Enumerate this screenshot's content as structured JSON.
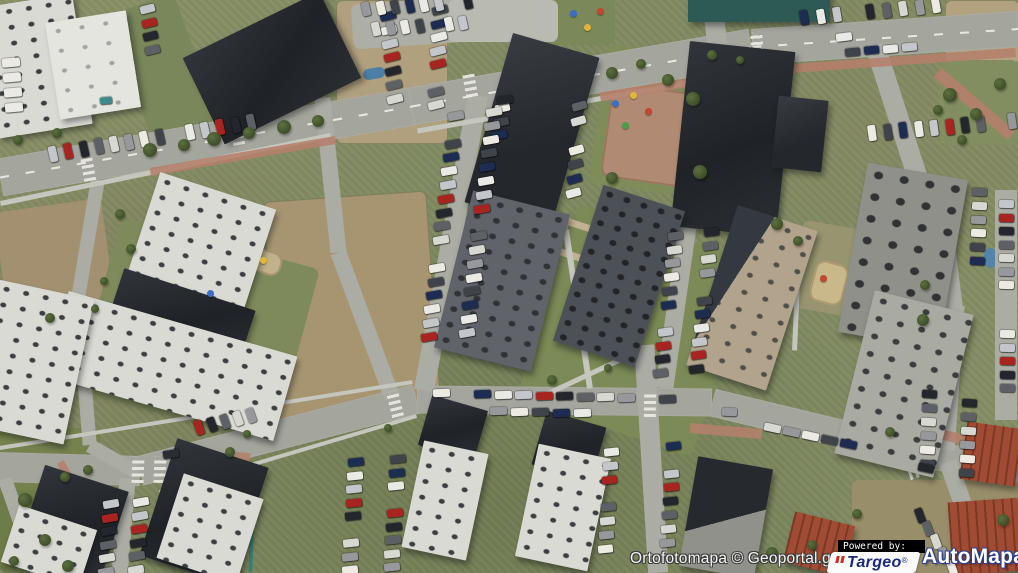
{
  "attribution": {
    "text": "Ortofotomapa © Geoportal.gov.pl"
  },
  "branding": {
    "powered_by": "Powered by:",
    "targeo": {
      "name": "Targeo",
      "reg": "®",
      "color": "#1b2a7d",
      "accent": "#cf2a21",
      "bg": "#fbfbfb"
    },
    "automapa": {
      "name": "AutoMapa",
      "reg": "®",
      "color": "#ffffff",
      "outline": "#2c3f8f"
    }
  },
  "map": {
    "type": "orthophoto-aerial",
    "scene": "residential blocks with dark flat-roof apartment buildings, roads, parking lots, lawns and dirt fields",
    "palette": {
      "grass": "#848d64",
      "road": "#a4a59d",
      "sidewalk": "#c5c6be",
      "brick_path": "#b5806b",
      "dark_roof": "#24272c",
      "light_roof": "#d9dad3",
      "red_roof": "#a04b33",
      "dirt": "#b1a07e"
    }
  },
  "features": {
    "patches": [
      [
        336,
        0,
        110,
        142,
        "#b1a07e",
        0,
        "dirt"
      ],
      [
        945,
        0,
        73,
        62,
        "#b2a280",
        0,
        "dirt"
      ],
      [
        0,
        205,
        108,
        100,
        "#a29070",
        -8,
        ""
      ],
      [
        270,
        196,
        162,
        218,
        "#a79572",
        -4,
        "dirt"
      ],
      [
        795,
        232,
        150,
        88,
        "#97946f",
        10,
        ""
      ],
      [
        852,
        480,
        168,
        93,
        "#998e6a",
        0,
        ""
      ],
      [
        543,
        228,
        185,
        205,
        "#7b8a57",
        18,
        ""
      ],
      [
        598,
        52,
        125,
        140,
        "#7e8c5a",
        8,
        ""
      ],
      [
        0,
        428,
        100,
        145,
        "#75824e",
        0,
        ""
      ],
      [
        95,
        240,
        205,
        180,
        "#7e8a5c",
        15,
        ""
      ],
      [
        130,
        0,
        70,
        145,
        "#79875a",
        -20,
        ""
      ],
      [
        545,
        0,
        70,
        45,
        "#7a885a",
        0,
        ""
      ],
      [
        940,
        60,
        78,
        85,
        "#828e60",
        0,
        ""
      ],
      [
        0,
        490,
        55,
        83,
        "#6e7c49",
        0,
        ""
      ],
      [
        606,
        88,
        92,
        95,
        "#b08a72",
        8,
        "play"
      ],
      [
        812,
        262,
        34,
        42,
        "#c9b98a",
        15,
        "play"
      ],
      [
        196,
        282,
        42,
        30,
        "#c2b28c",
        18,
        "play"
      ],
      [
        250,
        250,
        32,
        24,
        "#c2b28c",
        18,
        "play"
      ],
      [
        550,
        213,
        8,
        88,
        "#c0b292",
        18,
        ""
      ],
      [
        558,
        222,
        44,
        7,
        "#c0b292",
        18,
        ""
      ],
      [
        548,
        252,
        48,
        7,
        "#c0b292",
        18,
        ""
      ],
      [
        573,
        282,
        8,
        40,
        "#c0b292",
        18,
        ""
      ],
      [
        352,
        0,
        130,
        45,
        "#adaea6",
        -4,
        ""
      ],
      [
        448,
        0,
        110,
        42,
        "#b9bab2",
        0,
        ""
      ],
      [
        363,
        68,
        22,
        11,
        "#4d7fa6",
        -10,
        ""
      ],
      [
        984,
        248,
        13,
        20,
        "#5583aa",
        0,
        ""
      ],
      [
        250,
        484,
        4,
        88,
        "#3e7f74",
        2,
        ""
      ]
    ],
    "roads": [
      [
        0,
        177,
        412,
        106,
        38,
        "road"
      ],
      [
        412,
        106,
        752,
        47,
        38,
        "road"
      ],
      [
        752,
        47,
        1018,
        29,
        36,
        "road"
      ],
      [
        -5,
        467,
        140,
        471,
        30,
        "road"
      ],
      [
        140,
        471,
        417,
        399,
        30,
        "road"
      ],
      [
        417,
        399,
        712,
        402,
        28,
        "road"
      ],
      [
        712,
        402,
        940,
        457,
        28,
        "road"
      ],
      [
        940,
        457,
        1020,
        469,
        28,
        "road"
      ],
      [
        322,
        98,
        338,
        252,
        16,
        "road2"
      ],
      [
        338,
        252,
        392,
        397,
        16,
        "road2"
      ],
      [
        478,
        95,
        424,
        390,
        20,
        "road2"
      ],
      [
        687,
        228,
        664,
        388,
        18,
        "road2"
      ],
      [
        644,
        345,
        658,
        573,
        20,
        "road2"
      ],
      [
        875,
        45,
        921,
        188,
        20,
        "road2"
      ],
      [
        937,
        185,
        953,
        308,
        20,
        "road2"
      ],
      [
        955,
        305,
        945,
        450,
        20,
        "road2"
      ],
      [
        712,
        0,
        718,
        52,
        20,
        "road2"
      ],
      [
        948,
        462,
        972,
        530,
        18,
        "road2"
      ],
      [
        98,
        180,
        78,
        300,
        14,
        "road2"
      ],
      [
        78,
        300,
        90,
        445,
        14,
        "road2"
      ],
      [
        90,
        445,
        138,
        472,
        14,
        "road2"
      ],
      [
        128,
        478,
        120,
        573,
        16,
        "road2"
      ],
      [
        1006,
        190,
        1006,
        420,
        22,
        "road2"
      ],
      [
        5,
        478,
        38,
        573,
        14,
        "road2"
      ],
      [
        0,
        203,
        330,
        135,
        5,
        "path"
      ],
      [
        418,
        131,
        740,
        74,
        5,
        "path"
      ],
      [
        0,
        448,
        413,
        382,
        4,
        "path"
      ],
      [
        160,
        492,
        417,
        416,
        4,
        "path"
      ],
      [
        566,
        230,
        590,
        388,
        6,
        "path"
      ],
      [
        800,
        230,
        795,
        350,
        5,
        "path"
      ],
      [
        545,
        395,
        620,
        360,
        5,
        "path"
      ],
      [
        600,
        97,
        790,
        66,
        9,
        "redpath"
      ],
      [
        792,
        68,
        1015,
        52,
        9,
        "redpath"
      ],
      [
        938,
        72,
        1012,
        135,
        12,
        "redpath"
      ],
      [
        150,
        172,
        335,
        140,
        8,
        "redpath"
      ],
      [
        690,
        428,
        762,
        434,
        10,
        "redpath"
      ],
      [
        940,
        434,
        1012,
        452,
        10,
        "redpath"
      ],
      [
        244,
        452,
        238,
        505,
        14,
        "redpath"
      ],
      [
        60,
        462,
        75,
        490,
        8,
        "redpath"
      ],
      [
        0,
        177,
        412,
        106,
        2,
        "dash"
      ],
      [
        412,
        106,
        752,
        47,
        2,
        "dash"
      ],
      [
        752,
        47,
        1018,
        29,
        2,
        "dash"
      ]
    ],
    "crossings": [
      [
        88,
        168,
        -10
      ],
      [
        237,
        132,
        -10
      ],
      [
        470,
        84,
        -10
      ],
      [
        757,
        45,
        -4
      ],
      [
        395,
        404,
        -14
      ],
      [
        160,
        470,
        2
      ],
      [
        650,
        404,
        1
      ],
      [
        905,
        455,
        13
      ],
      [
        138,
        470,
        2
      ],
      [
        921,
        470,
        70
      ]
    ],
    "buildings": [
      [
        -12,
        0,
        95,
        132,
        -9,
        "light"
      ],
      [
        52,
        16,
        82,
        98,
        -9,
        "lighter"
      ],
      [
        196,
        20,
        152,
        96,
        -26,
        "dark"
      ],
      [
        487,
        42,
        90,
        176,
        16,
        "dark2"
      ],
      [
        680,
        46,
        106,
        186,
        6,
        "dark"
      ],
      [
        775,
        98,
        50,
        72,
        6,
        "dark2"
      ],
      [
        688,
        -10,
        142,
        32,
        0,
        "teal"
      ],
      [
        852,
        170,
        102,
        172,
        10,
        "graydark"
      ],
      [
        452,
        200,
        100,
        162,
        14,
        "gray2"
      ],
      [
        576,
        194,
        86,
        164,
        18,
        "gray3"
      ],
      [
        710,
        214,
        84,
        168,
        18,
        "tanmix"
      ],
      [
        853,
        300,
        102,
        168,
        14,
        "lightdark"
      ],
      [
        140,
        188,
        122,
        112,
        18,
        "light"
      ],
      [
        112,
        288,
        138,
        58,
        18,
        "dark"
      ],
      [
        52,
        322,
        238,
        88,
        16,
        "light"
      ],
      [
        -18,
        288,
        98,
        148,
        12,
        "light"
      ],
      [
        28,
        476,
        88,
        97,
        18,
        "dark"
      ],
      [
        8,
        516,
        82,
        60,
        18,
        "light"
      ],
      [
        156,
        450,
        96,
        123,
        18,
        "dark"
      ],
      [
        168,
        484,
        84,
        89,
        18,
        "light"
      ],
      [
        424,
        402,
        58,
        52,
        16,
        "dark"
      ],
      [
        412,
        446,
        66,
        109,
        12,
        "light"
      ],
      [
        538,
        418,
        62,
        56,
        16,
        "dark"
      ],
      [
        526,
        450,
        74,
        115,
        12,
        "light"
      ],
      [
        688,
        462,
        76,
        111,
        10,
        "darkmix"
      ],
      [
        843,
        543,
        58,
        30,
        -4,
        "lighter"
      ],
      [
        788,
        518,
        62,
        52,
        14,
        "red"
      ],
      [
        950,
        500,
        70,
        73,
        -4,
        "red"
      ],
      [
        963,
        425,
        56,
        58,
        8,
        "red"
      ]
    ],
    "car_rows": [
      [
        34,
        148,
        15.2,
        -2.4,
        15,
        8,
        16,
        -13
      ],
      [
        380,
        12,
        1.2,
        13.8,
        7,
        16,
        8,
        -14
      ],
      [
        432,
        6,
        -0.6,
        13.6,
        8,
        16,
        8,
        -14
      ],
      [
        495,
        104,
        -1.5,
        13.5,
        3,
        15,
        8,
        -12
      ],
      [
        448,
        112,
        -1.7,
        13.8,
        17,
        16,
        8,
        -10
      ],
      [
        486,
        108,
        -1.7,
        13.8,
        18,
        16,
        8,
        -10
      ],
      [
        668,
        232,
        -1.5,
        13.7,
        11,
        15,
        8,
        -8
      ],
      [
        704,
        228,
        -1.5,
        13.7,
        11,
        15,
        8,
        -8
      ],
      [
        195,
        420,
        13,
        -3,
        5,
        8,
        15,
        -20
      ],
      [
        103,
        500,
        -1,
        13.5,
        6,
        16,
        8,
        -10
      ],
      [
        133,
        498,
        -1,
        13.5,
        6,
        16,
        8,
        -10
      ],
      [
        348,
        458,
        -0.8,
        13.5,
        9,
        16,
        8,
        -6
      ],
      [
        390,
        455,
        -0.8,
        13.5,
        9,
        16,
        8,
        -6
      ],
      [
        433,
        389,
        20.5,
        0.5,
        12,
        17,
        8,
        -2
      ],
      [
        490,
        407,
        21,
        0.5,
        5,
        17,
        8,
        -2
      ],
      [
        764,
        424,
        19,
        4,
        5,
        17,
        8,
        12
      ],
      [
        972,
        188,
        -0.5,
        13.8,
        6,
        15,
        8,
        3
      ],
      [
        922,
        390,
        -0.5,
        14,
        6,
        15,
        8,
        4
      ],
      [
        962,
        385,
        -0.5,
        14,
        7,
        15,
        8,
        4
      ],
      [
        999,
        200,
        0,
        13.5,
        7,
        15,
        8,
        1
      ],
      [
        1000,
        330,
        0,
        13.5,
        5,
        15,
        8,
        1
      ],
      [
        800,
        10,
        16.5,
        -1.5,
        9,
        8,
        15,
        -10
      ],
      [
        845,
        48,
        19,
        -1.7,
        4,
        15,
        8,
        -5
      ],
      [
        868,
        125,
        15.5,
        -1.3,
        10,
        8,
        16,
        -8
      ],
      [
        362,
        2,
        14.5,
        -1,
        8,
        8,
        14,
        -13
      ],
      [
        372,
        22,
        14.5,
        -1,
        7,
        8,
        14,
        -13
      ],
      [
        572,
        102,
        -1,
        14.5,
        7,
        15,
        8,
        -16
      ],
      [
        916,
        508,
        8,
        13,
        5,
        8,
        15,
        -20
      ],
      [
        2,
        58,
        1,
        15,
        4,
        18,
        9,
        -5,
        "#eceae4"
      ],
      [
        140,
        5,
        1.5,
        13.5,
        4,
        15,
        8,
        -14
      ],
      [
        604,
        448,
        -0.8,
        13.8,
        8,
        15,
        8,
        -6
      ],
      [
        666,
        442,
        -0.8,
        13.8,
        8,
        15,
        8,
        -6
      ],
      [
        497,
        96,
        0,
        0,
        1,
        16,
        8,
        -10,
        "#23262c"
      ],
      [
        163,
        450,
        0,
        0,
        1,
        16,
        8,
        -8,
        "#2a2d33"
      ],
      [
        836,
        33,
        0,
        0,
        1,
        16,
        8,
        -7,
        "#e9eae6"
      ],
      [
        918,
        464,
        0,
        0,
        1,
        16,
        8,
        12,
        "#23262c"
      ],
      [
        722,
        408,
        0,
        0,
        1,
        15,
        8,
        2,
        "#97989c"
      ],
      [
        100,
        97,
        0,
        0,
        1,
        12,
        7,
        -5,
        "#3e8a8c"
      ]
    ],
    "car_palette": [
      "#e9eae6",
      "#23262c",
      "#97989c",
      "#1d2c50",
      "#a82420",
      "#d7d8d2",
      "#3f434a",
      "#c3c6ca",
      "#5d6166",
      "#eceae2"
    ],
    "trees": [
      [
        150,
        150,
        7
      ],
      [
        184,
        145,
        6
      ],
      [
        214,
        139,
        7
      ],
      [
        249,
        133,
        6
      ],
      [
        284,
        127,
        7
      ],
      [
        318,
        121,
        6
      ],
      [
        18,
        140,
        5
      ],
      [
        57,
        133,
        5
      ],
      [
        612,
        73,
        6
      ],
      [
        641,
        64,
        5
      ],
      [
        668,
        80,
        6
      ],
      [
        693,
        99,
        7
      ],
      [
        612,
        178,
        6
      ],
      [
        700,
        172,
        7
      ],
      [
        777,
        224,
        6
      ],
      [
        798,
        241,
        5
      ],
      [
        950,
        95,
        7
      ],
      [
        976,
        114,
        6
      ],
      [
        1000,
        84,
        6
      ],
      [
        962,
        140,
        5
      ],
      [
        938,
        110,
        5
      ],
      [
        925,
        285,
        5
      ],
      [
        923,
        320,
        6
      ],
      [
        1003,
        520,
        6
      ],
      [
        857,
        514,
        5
      ],
      [
        772,
        553,
        6
      ],
      [
        812,
        545,
        5
      ],
      [
        25,
        500,
        7
      ],
      [
        45,
        540,
        6
      ],
      [
        14,
        561,
        5
      ],
      [
        68,
        566,
        6
      ],
      [
        88,
        470,
        5
      ],
      [
        65,
        477,
        5
      ],
      [
        230,
        452,
        5
      ],
      [
        388,
        428,
        4
      ],
      [
        247,
        434,
        4
      ],
      [
        120,
        214,
        5
      ],
      [
        131,
        249,
        5
      ],
      [
        104,
        281,
        4
      ],
      [
        50,
        318,
        5
      ],
      [
        95,
        309,
        4
      ],
      [
        552,
        380,
        5
      ],
      [
        608,
        368,
        4
      ],
      [
        890,
        432,
        5
      ],
      [
        712,
        55,
        5
      ],
      [
        740,
        60,
        4
      ]
    ],
    "play_dots": [
      [
        570,
        10,
        "#3a6fc4"
      ],
      [
        584,
        24,
        "#e0b63a"
      ],
      [
        597,
        8,
        "#c24632"
      ],
      [
        612,
        100,
        "#3a6fc4"
      ],
      [
        630,
        92,
        "#e0b63a"
      ],
      [
        645,
        108,
        "#c24632"
      ],
      [
        622,
        122,
        "#49a04b"
      ],
      [
        820,
        275,
        "#c24632"
      ],
      [
        207,
        290,
        "#3a6fc4"
      ],
      [
        260,
        257,
        "#e0b63a"
      ]
    ]
  }
}
